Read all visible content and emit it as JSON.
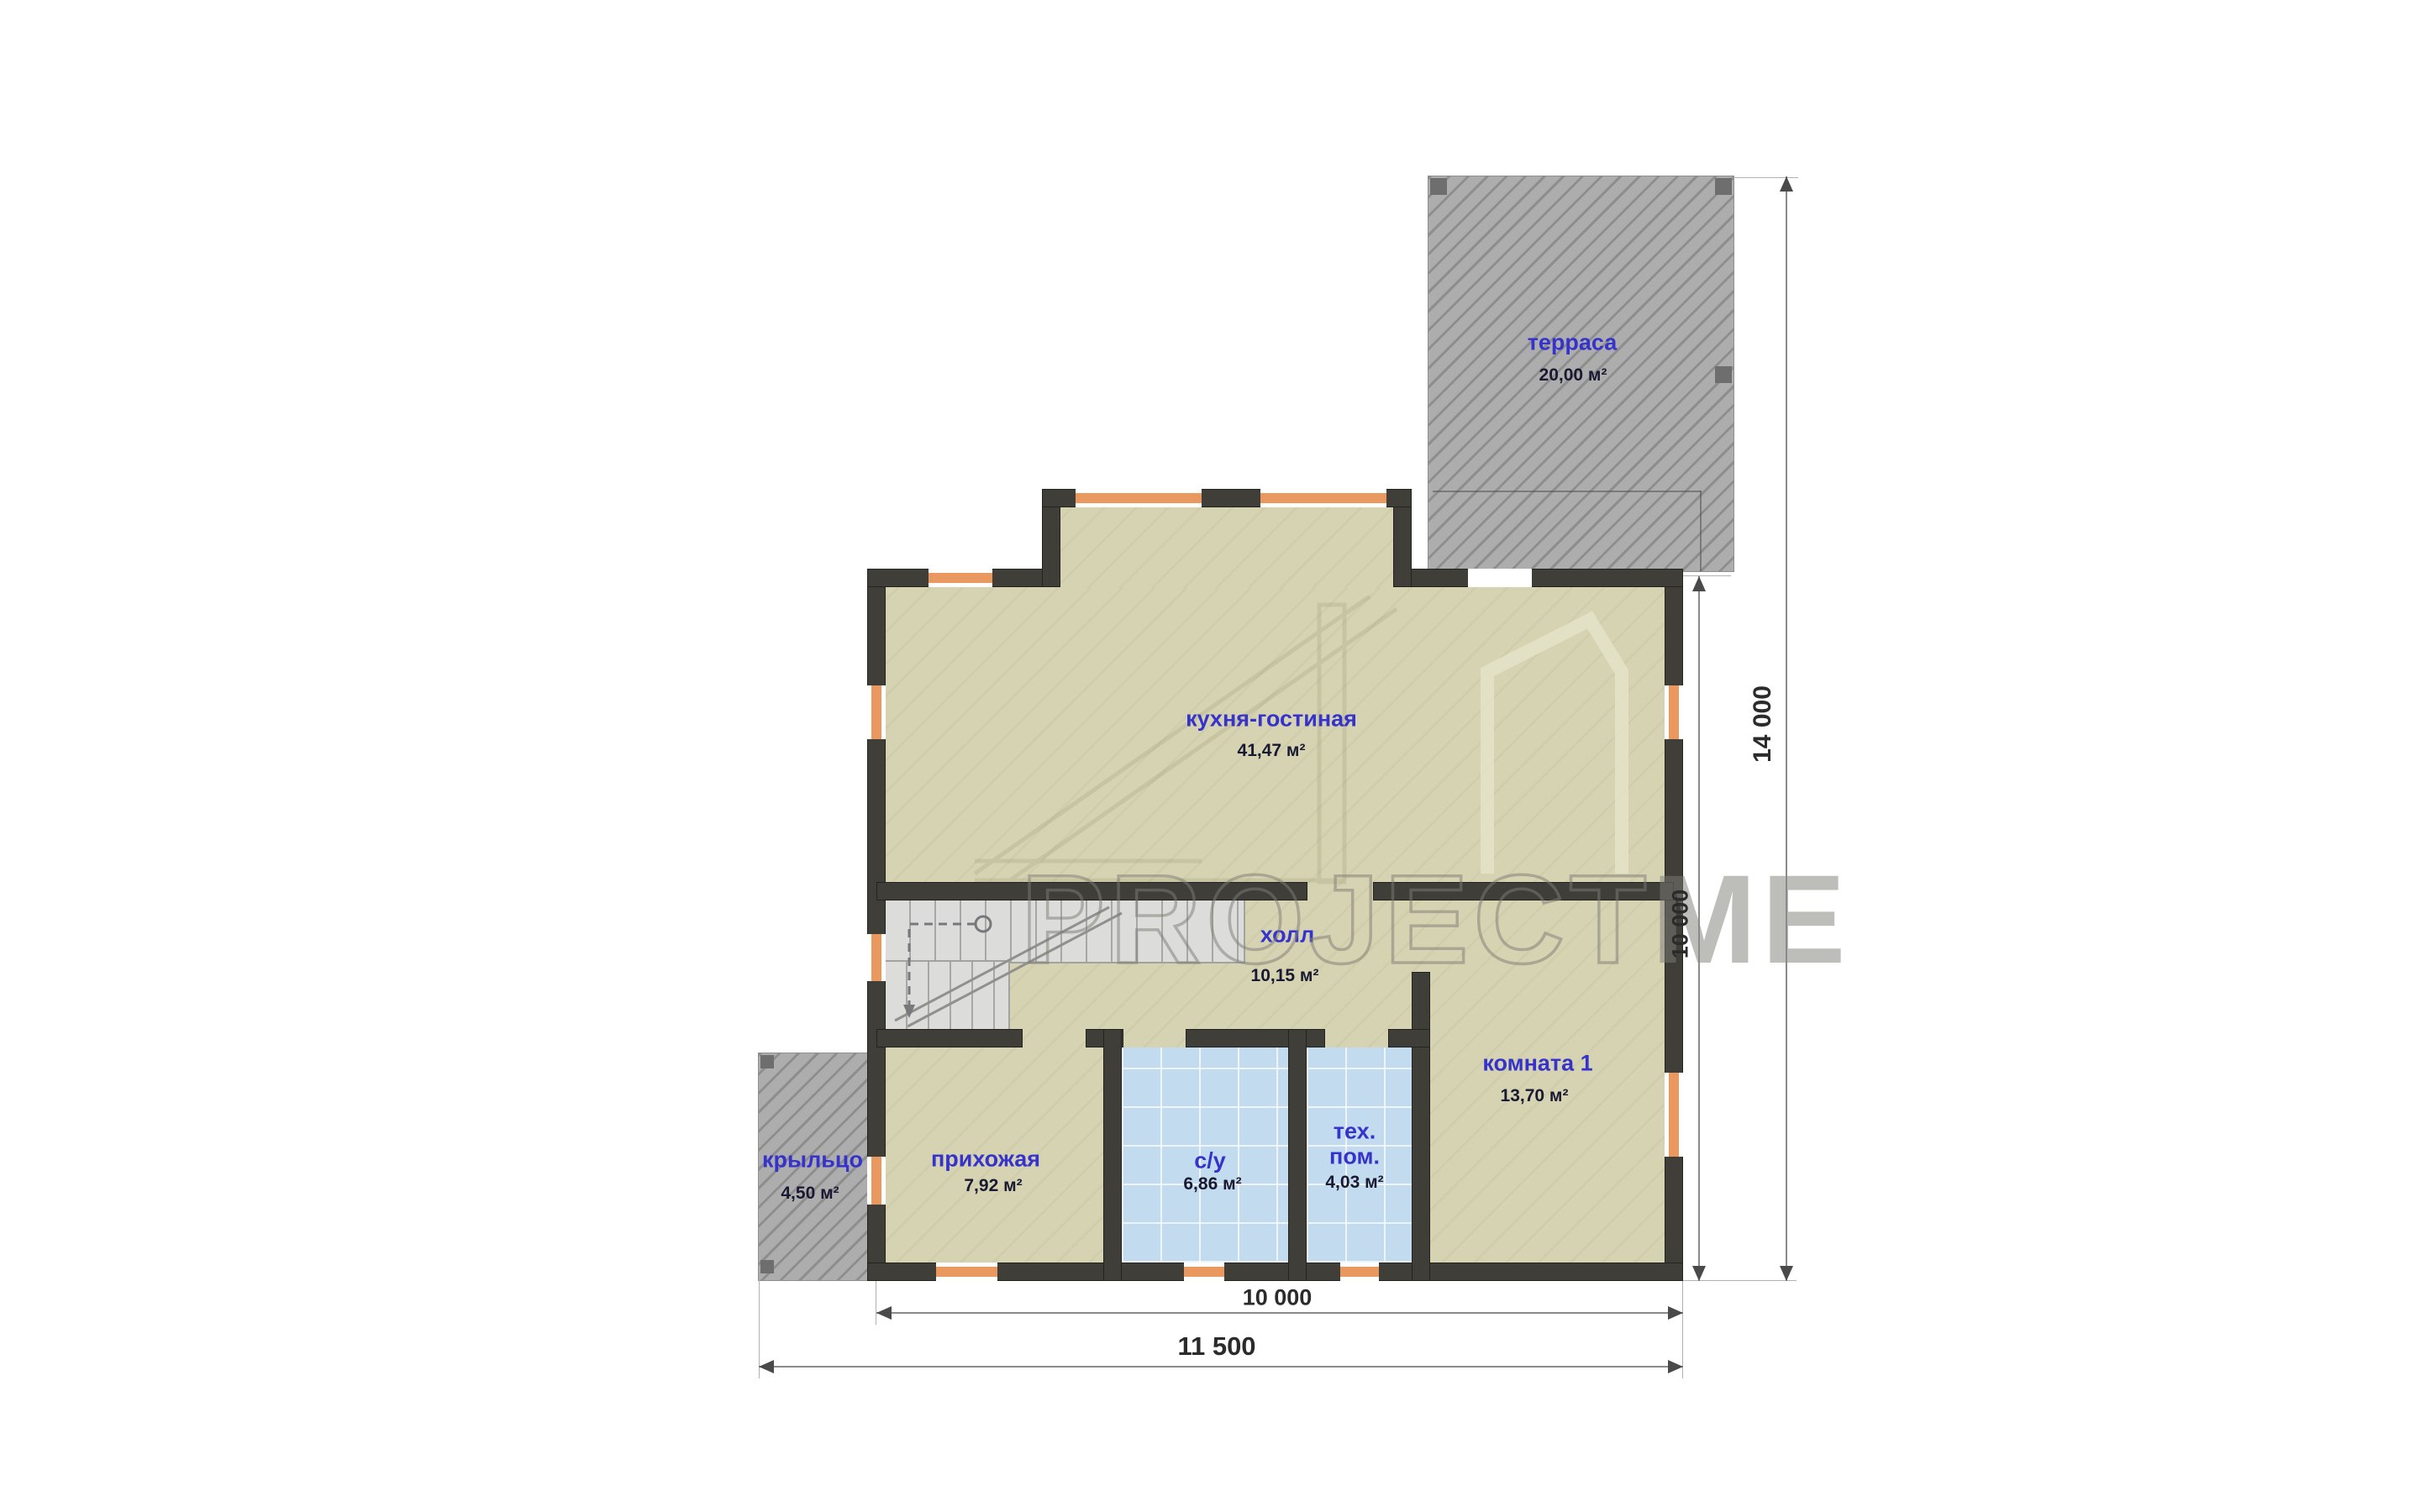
{
  "rooms": {
    "terrace": {
      "name": "терраса",
      "area": "20,00 м²"
    },
    "kitchen_living": {
      "name": "кухня-гостиная",
      "area": "41,47 м²"
    },
    "hall": {
      "name": "холл",
      "area": "10,15 м²"
    },
    "room1": {
      "name": "комната 1",
      "area": "13,70 м²"
    },
    "hallway": {
      "name": "прихожая",
      "area": "7,92 м²"
    },
    "bathroom": {
      "name": "с/у",
      "area": "6,86 м²"
    },
    "tech_room": {
      "name_line1": "тех.",
      "name_line2": "пом.",
      "area": "4,03 м²"
    },
    "porch": {
      "name": "крыльцо",
      "area": "4,50 м²"
    }
  },
  "dimensions": {
    "right_outer": "14 000",
    "right_inner": "10 000",
    "bottom_inner": "10 000",
    "bottom_outer": "11 500"
  },
  "watermark": {
    "part1": "PROJECT",
    "part2": "ME"
  },
  "colors": {
    "floor_beige": "#d6d3b2",
    "wall_dark": "#3f3e38",
    "tile_blue": "#c3dbee",
    "window_orange": "#e9995f",
    "hatch_gray": "#adadad",
    "label_blue": "#3533cc",
    "value_dark": "#191932"
  }
}
